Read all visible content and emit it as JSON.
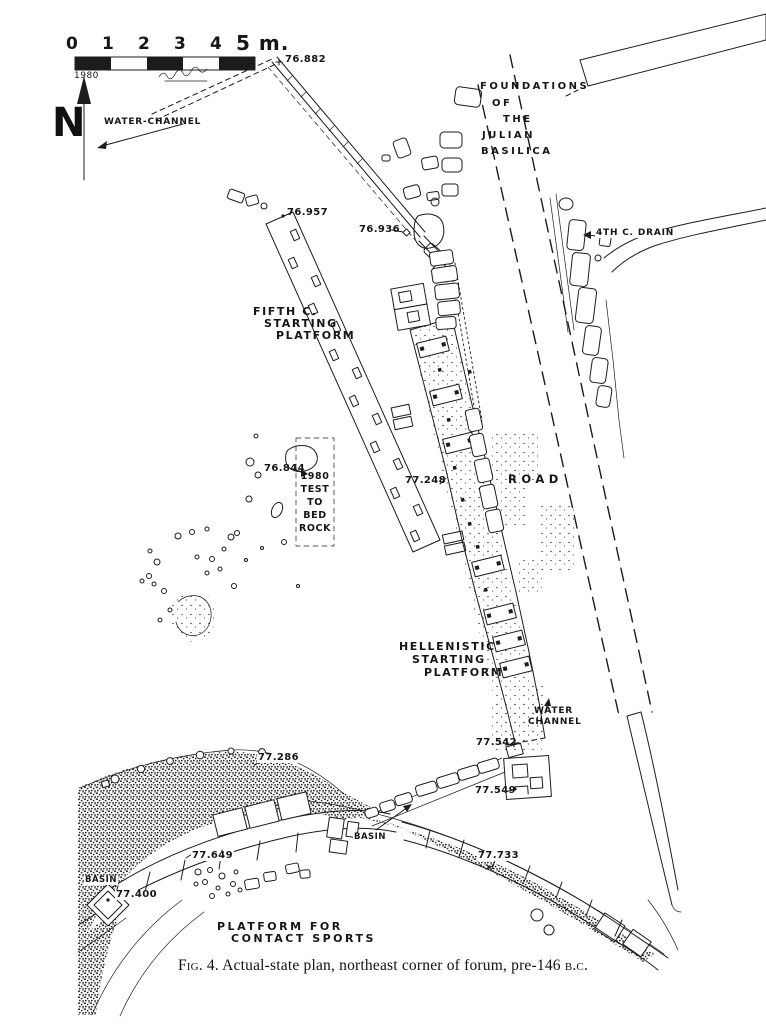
{
  "figure": {
    "caption_fig": "Fig.",
    "caption_rest": "4. Actual-state plan, northeast corner of forum, pre-146",
    "caption_era": "b.c."
  },
  "scale_bar": {
    "ticks": [
      "0",
      "1",
      "2",
      "3",
      "4"
    ],
    "unit_label": "5 m.",
    "year": "1980"
  },
  "compass": {
    "north_letter": "N"
  },
  "labels": {
    "water_channel_top": "WATER-CHANNEL",
    "foundations_lines": [
      "FOUNDATIONS",
      "OF",
      "THE",
      "JULIAN",
      "BASILICA"
    ],
    "fourth_c_drain": "4TH C. DRAIN",
    "fifth_c_platform_lines": [
      "FIFTH C.",
      "STARTING",
      "PLATFORM"
    ],
    "test_pit_lines": [
      "1980",
      "TEST",
      "TO",
      "BED",
      "ROCK"
    ],
    "road": "ROAD",
    "hellenistic_platform_lines": [
      "HELLENISTIC",
      "STARTING",
      "PLATFORM"
    ],
    "water_channel_bottom_lines": [
      "WATER",
      "CHANNEL"
    ],
    "basin_west": "BASIN",
    "basin_center": "BASIN",
    "platform_contact_sports_lines": [
      "PLATFORM FOR",
      "CONTACT SPORTS"
    ]
  },
  "elevations": {
    "e76_882": "76.882",
    "e76_957": "76.957",
    "e76_936": "76.936",
    "e76_844": "76.844",
    "e77_248": "77.248",
    "e77_542": "77.542",
    "e77_549": "77.549",
    "e77_286": "77.286",
    "e77_649": "77.649",
    "e77_400": "77.400",
    "e77_733": "77.733"
  }
}
